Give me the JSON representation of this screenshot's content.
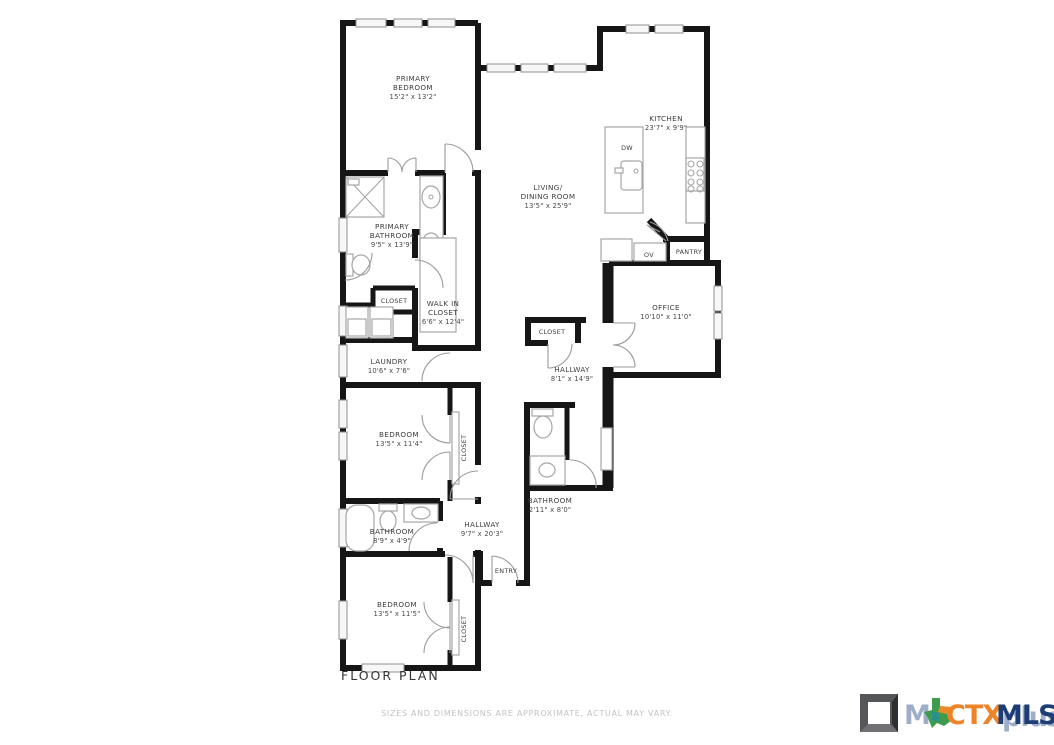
{
  "title": "FLOOR PLAN",
  "disclaimer": "SIZES AND DIMENSIONS ARE APPROXIMATE, ACTUAL MAY VARY.",
  "rooms": {
    "primary_bedroom": {
      "l1": "PRIMARY",
      "l2": "BEDROOM",
      "dims": "15'2\" x 13'2\""
    },
    "kitchen": {
      "l1": "KITCHEN",
      "dims": "23'7\" x 9'9\""
    },
    "living": {
      "l1": "LIVING/",
      "l2": "DINING ROOM",
      "dims": "13'5\" x 25'9\""
    },
    "primary_bathroom": {
      "l1": "PRIMARY",
      "l2": "BATHROOM",
      "dims": "9'5\" x 13'9\""
    },
    "closet_bath": {
      "l1": "CLOSET"
    },
    "walk_in_closet": {
      "l1": "WALK IN",
      "l2": "CLOSET",
      "dims": "6'6\" x 12'4\""
    },
    "laundry": {
      "l1": "LAUNDRY",
      "dims": "10'6\" x 7'6\""
    },
    "bedroom_mid": {
      "l1": "BEDROOM",
      "dims": "13'5\" x 11'4\""
    },
    "closet_mid": {
      "l1": "CLOSET"
    },
    "bathroom_mid": {
      "l1": "BATHROOM",
      "dims": "8'9\" x 4'9\""
    },
    "hallway_lower": {
      "l1": "HALLWAY",
      "dims": "9'7\" x 20'3\""
    },
    "entry": {
      "l1": "ENTRY"
    },
    "bedroom_bottom": {
      "l1": "BEDROOM",
      "dims": "13'5\" x 11'5\""
    },
    "closet_bottom": {
      "l1": "CLOSET"
    },
    "bathroom_small": {
      "l1": "BATHROOM",
      "dims": "2'11\" x 8'0\""
    },
    "hallway_upper": {
      "l1": "HALLWAY",
      "dims": "8'1\" x 14'9\""
    },
    "closet_hall": {
      "l1": "CLOSET"
    },
    "office": {
      "l1": "OFFICE",
      "dims": "10'10\" x 11'0\""
    },
    "pantry": {
      "l1": "PANTRY"
    },
    "oven": {
      "l1": "OV"
    },
    "dishwasher": {
      "l1": "DW"
    }
  },
  "colors": {
    "wall": "#161616",
    "fixture": "#a6a6a6",
    "label": "#3c3c3c",
    "ctx_orange": "#ef8328",
    "mls_navy": "#1d3e74",
    "ghost_navy": "#2a4d86",
    "texas_green": "#3e9d4d",
    "texas_orange": "#e98a2b",
    "texas_teal": "#2b8f8c",
    "cube_gray": "#55565a"
  },
  "logo": {
    "m": "M",
    "ctx": "CTX",
    "mls": "MLS",
    "ghost": "plus"
  }
}
